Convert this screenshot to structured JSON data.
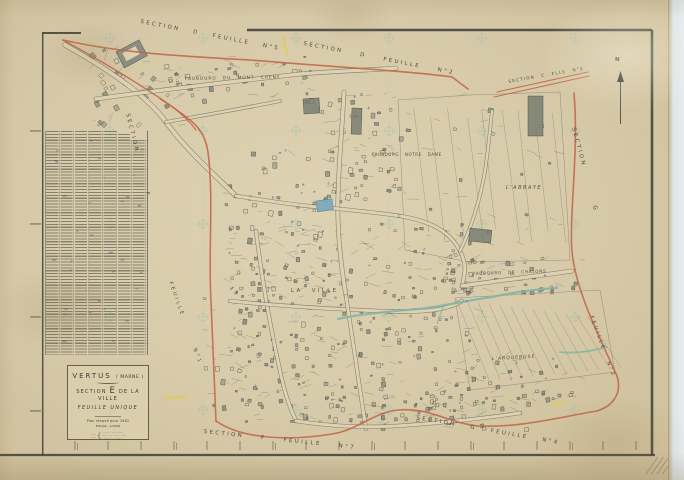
{
  "colors": {
    "paper": "#d9cdad",
    "street_paper": "#ddd2b2",
    "ink": "#46463e",
    "boundary_red": "#c0664a",
    "water_teal": "#7fb3a8",
    "pond_blue": "#7fa9bf",
    "annotation_purple": "#7b5ea6",
    "grid_teal": "#8fbcb2",
    "yellow_mark": "#e0cb55",
    "building_gray": "#99a091",
    "frame_dark": "#3d3d37"
  },
  "edge_labels": [
    {
      "id": "top-left",
      "text": "SECTION D FEUILLE N°5"
    },
    {
      "id": "top-right",
      "text": "SECTION D FEUILLE N°2"
    },
    {
      "id": "corner-ne",
      "text": "SECTION C FLLE N°2"
    },
    {
      "id": "right-upper",
      "text": "SECTION G"
    },
    {
      "id": "right-lower",
      "text": "FEUILLE N°2"
    },
    {
      "id": "left-upper",
      "text": "SECTION F"
    },
    {
      "id": "left-lower",
      "text": "FEUILLE N°1"
    },
    {
      "id": "bottom-left",
      "text": "SECTION F FEUILLE N°7"
    },
    {
      "id": "bottom-right",
      "text": "SECTION G FEUILLE N°4"
    }
  ],
  "map_labels": [
    {
      "id": "faubourg-mont-cheny",
      "text": "FAUBOURG DU MONT CHENY"
    },
    {
      "id": "faubourg-notre-dame",
      "text": "FAUBOURG NOTRE DAME"
    },
    {
      "id": "abbaye",
      "text": "L'ABBAYE"
    },
    {
      "id": "la-ville",
      "text": "LA VILLE"
    },
    {
      "id": "faubourg-chalons",
      "text": "FAUBOURG DE CHALONS"
    },
    {
      "id": "arquebuse",
      "text": "L'ARQUEBUSE"
    }
  ],
  "compass": {
    "north": "N"
  },
  "title_block": {
    "commune": "VERTUS",
    "commune_dept": "( MARNE )",
    "section_pre": "SECTION",
    "section_letter": "E",
    "section_post": "DE LA VILLE",
    "feuille": "FEUILLE UNIQUE",
    "revision": "Plan rénové pour 1962",
    "scale": "Echelle : 1/1000",
    "micro_left_1": "—·—",
    "micro_left_2": "··——",
    "micro_brace": "{",
    "micro_right_1": "··— — ·· —— ——— ·",
    "micro_right_2": "—— ·· — ··· —— · ——",
    "micro_right_3": "· ——— ·· ···· ——"
  }
}
